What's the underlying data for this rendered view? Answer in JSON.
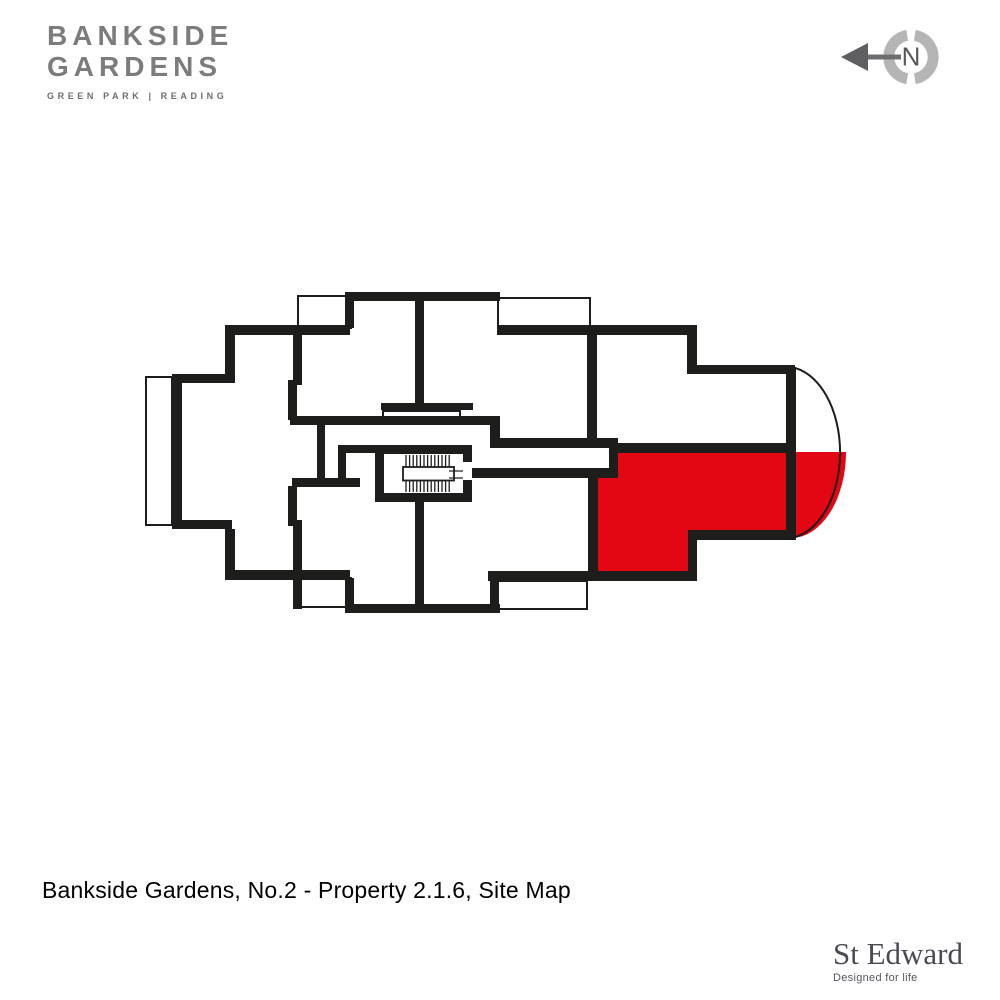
{
  "branding": {
    "logo_line1": "BANKSIDE",
    "logo_line2": "GARDENS",
    "logo_tagline": "GREEN PARK | READING"
  },
  "compass": {
    "label": "N"
  },
  "plan": {
    "caption": "Bankside Gardens, No.2 - Property 2.1.6, Site Map",
    "development": "Bankside Gardens",
    "building": "No.2",
    "property_id": "2.1.6",
    "view": "Site Map",
    "highlight_color": "#e30613",
    "wall_color": "#1d1d1b"
  },
  "footer": {
    "brand": "St Edward",
    "tagline": "Designed for life"
  }
}
